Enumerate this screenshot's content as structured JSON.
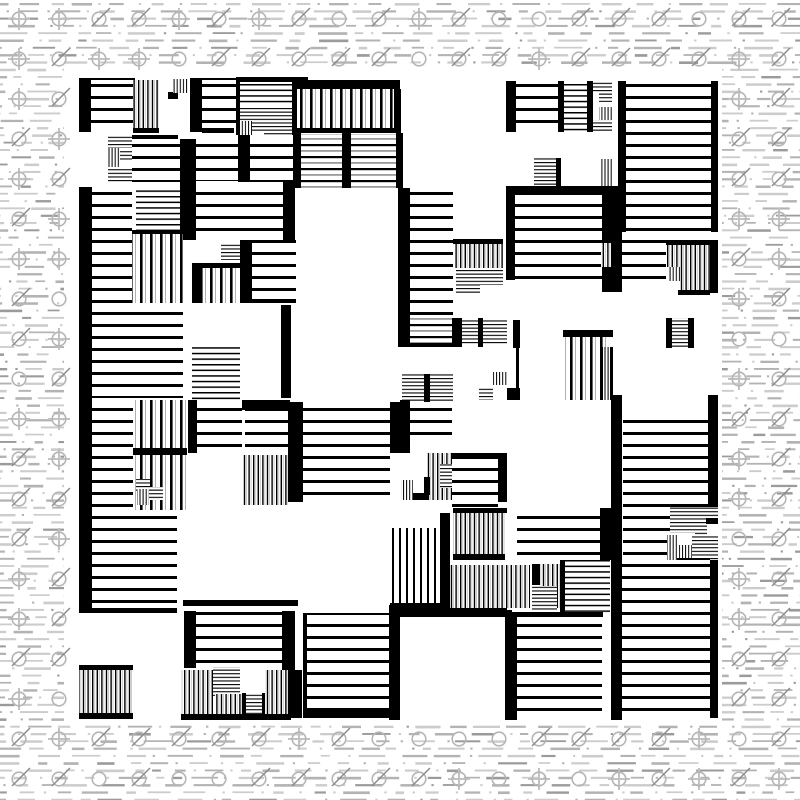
{
  "image": {
    "width": 800,
    "height": 800,
    "kind": "generative-abstract-print",
    "description": "Black-and-white generative artwork: a dense maze-like composition of solid black bars and hatched rectangles (horizontal and vertical stripes of several pitches) on a white square canvas, placed over a light technical background of gray dashed lines and circle-slash symbols"
  },
  "palette": {
    "ink": "#000000",
    "paper": "#ffffff",
    "dash_light": "#cccccc",
    "dash_mid": "#b3b3b3",
    "dash_dark": "#9b9b9b",
    "symbol_circle": "#b5b5b5",
    "symbol_slash": "#8a8a8a",
    "symbol_cross": "#c2c2c2"
  },
  "canvas": {
    "x": 64,
    "y": 64,
    "width": 658,
    "height": 658,
    "background": "#ffffff"
  },
  "margin_pattern": {
    "row_pitch": 7.3,
    "row_start": 3,
    "dash_min_len": 8,
    "dash_max_len": 30,
    "gap_min": 5,
    "gap_max": 19,
    "dot_size": 2.3,
    "dot_probability": 0.38,
    "symbol_grid_origin": 19,
    "symbol_grid_pitch": 40,
    "symbol_radius": 6.8,
    "symbol_types": [
      "slash-circle",
      "crosshair-circle",
      "plain-circle"
    ],
    "seed": 1337
  },
  "stripe_patterns": [
    {
      "id": "h-lg",
      "orientation": "horizontal",
      "pitch": 12,
      "line_thickness": 3,
      "line_color": "#000000"
    },
    {
      "id": "h-md",
      "orientation": "horizontal",
      "pitch": 12,
      "line_thickness": 2.2,
      "line_color": "#000000",
      "accent": {
        "offset": 6,
        "thickness": 1.8,
        "color": "#9a9a9a"
      }
    },
    {
      "id": "h-sm",
      "orientation": "horizontal",
      "pitch": 5.6,
      "line_thickness": 1.5,
      "line_color": "#000000"
    },
    {
      "id": "h-xs",
      "orientation": "horizontal",
      "pitch": 3.6,
      "line_thickness": 1.1,
      "line_color": "#000000"
    },
    {
      "id": "v-lg",
      "orientation": "vertical",
      "pitch": 10,
      "line_thickness": 2.6,
      "line_color": "#000000",
      "accent": {
        "offset": 5,
        "thickness": 1,
        "color": "#b0b0b0"
      }
    },
    {
      "id": "v-md",
      "orientation": "vertical",
      "pitch": 7,
      "line_thickness": 2,
      "line_color": "#000000"
    },
    {
      "id": "v-sm",
      "orientation": "vertical",
      "pitch": 4.6,
      "line_thickness": 1.4,
      "line_color": "#000000",
      "accent": {
        "offset": 2.3,
        "thickness": 0.7,
        "color": "#b8b8b8"
      }
    },
    {
      "id": "v-xs",
      "orientation": "vertical",
      "pitch": 3.1,
      "line_thickness": 1,
      "line_color": "#000000"
    }
  ],
  "blocks": {
    "legend": [
      "x",
      "y",
      "width",
      "height",
      "fill"
    ],
    "rects": [
      [
        79,
        78,
        56,
        4,
        "solid"
      ],
      [
        79,
        80,
        12,
        52,
        "solid"
      ],
      [
        91,
        80,
        42,
        52,
        "h-lg"
      ],
      [
        133,
        80,
        26,
        48,
        "v-sm"
      ],
      [
        133,
        128,
        26,
        5,
        "solid"
      ],
      [
        168,
        92,
        10,
        7,
        "solid"
      ],
      [
        173,
        79,
        15,
        14,
        "v-xs"
      ],
      [
        190,
        78,
        52,
        4,
        "solid"
      ],
      [
        190,
        80,
        12,
        52,
        "solid"
      ],
      [
        202,
        80,
        40,
        48,
        "h-lg"
      ],
      [
        202,
        128,
        32,
        5,
        "solid"
      ],
      [
        236,
        77,
        4,
        60,
        "solid"
      ],
      [
        239,
        77,
        69,
        5,
        "solid"
      ],
      [
        240,
        82,
        53,
        22,
        "h-sm"
      ],
      [
        240,
        106,
        24,
        15,
        "h-xs"
      ],
      [
        264,
        106,
        29,
        31,
        "h-xs"
      ],
      [
        240,
        121,
        12,
        16,
        "v-xs"
      ],
      [
        252,
        121,
        12,
        10,
        "h-xs"
      ],
      [
        292,
        82,
        5,
        55,
        "solid"
      ],
      [
        293,
        80,
        107,
        9,
        "solid"
      ],
      [
        297,
        89,
        97,
        39,
        "v-lg"
      ],
      [
        394,
        89,
        7,
        43,
        "solid"
      ],
      [
        293,
        128,
        108,
        5,
        "solid"
      ],
      [
        108,
        135,
        24,
        13,
        "h-xs"
      ],
      [
        107,
        148,
        13,
        19,
        "v-xs"
      ],
      [
        120,
        149,
        13,
        11,
        "h-xs"
      ],
      [
        108,
        167,
        24,
        16,
        "h-xs"
      ],
      [
        132,
        135,
        46,
        4,
        "solid"
      ],
      [
        132,
        139,
        48,
        43,
        "h-lg"
      ],
      [
        180,
        139,
        16,
        101,
        "solid"
      ],
      [
        196,
        135,
        42,
        46,
        "h-lg"
      ],
      [
        238,
        135,
        12,
        47,
        "solid"
      ],
      [
        250,
        135,
        43,
        47,
        "h-lg"
      ],
      [
        293,
        133,
        8,
        55,
        "solid"
      ],
      [
        301,
        134,
        41,
        54,
        "h-md"
      ],
      [
        342,
        133,
        9,
        55,
        "solid"
      ],
      [
        351,
        134,
        45,
        54,
        "h-md"
      ],
      [
        396,
        133,
        7,
        55,
        "solid"
      ],
      [
        79,
        187,
        13,
        213,
        "solid"
      ],
      [
        92,
        187,
        40,
        116,
        "h-lg"
      ],
      [
        136,
        189,
        44,
        41,
        "h-sm"
      ],
      [
        196,
        183,
        87,
        57,
        "h-lg"
      ],
      [
        283,
        181,
        12,
        59,
        "solid"
      ],
      [
        132,
        230,
        51,
        4,
        "solid"
      ],
      [
        132,
        234,
        51,
        69,
        "v-lg"
      ],
      [
        221,
        243,
        21,
        17,
        "h-xs"
      ],
      [
        192,
        263,
        51,
        5,
        "solid"
      ],
      [
        192,
        268,
        10,
        35,
        "solid"
      ],
      [
        202,
        268,
        41,
        35,
        "v-lg"
      ],
      [
        240,
        240,
        12,
        63,
        "solid"
      ],
      [
        252,
        240,
        44,
        63,
        "h-lg"
      ],
      [
        242,
        299,
        54,
        4,
        "solid"
      ],
      [
        92,
        303,
        91,
        95,
        "h-lg"
      ],
      [
        192,
        345,
        48,
        55,
        "h-sm"
      ],
      [
        281,
        305,
        10,
        93,
        "solid"
      ],
      [
        506,
        81,
        10,
        51,
        "solid"
      ],
      [
        516,
        81,
        42,
        51,
        "h-lg"
      ],
      [
        558,
        81,
        6,
        51,
        "solid"
      ],
      [
        564,
        81,
        23,
        51,
        "h-sm"
      ],
      [
        587,
        81,
        6,
        51,
        "solid"
      ],
      [
        593,
        81,
        19,
        11,
        "h-xs"
      ],
      [
        599,
        92,
        13,
        10,
        "h-xs"
      ],
      [
        599,
        107,
        13,
        13,
        "v-xs"
      ],
      [
        593,
        120,
        19,
        12,
        "h-xs"
      ],
      [
        618,
        81,
        8,
        151,
        "solid"
      ],
      [
        626,
        81,
        85,
        151,
        "h-lg"
      ],
      [
        711,
        81,
        7,
        151,
        "solid"
      ],
      [
        534,
        158,
        24,
        29,
        "h-xs"
      ],
      [
        556,
        158,
        5,
        29,
        "solid"
      ],
      [
        601,
        159,
        11,
        27,
        "v-xs"
      ],
      [
        506,
        186,
        97,
        7,
        "solid"
      ],
      [
        506,
        193,
        9,
        87,
        "solid"
      ],
      [
        515,
        193,
        87,
        87,
        "h-lg"
      ],
      [
        602,
        186,
        20,
        106,
        "solid"
      ],
      [
        622,
        232,
        44,
        51,
        "h-lg"
      ],
      [
        601,
        243,
        10,
        24,
        "v-sm"
      ],
      [
        666,
        240,
        50,
        5,
        "solid"
      ],
      [
        666,
        245,
        44,
        22,
        "v-sm"
      ],
      [
        668,
        267,
        12,
        14,
        "v-xs"
      ],
      [
        680,
        266,
        30,
        25,
        "v-sm"
      ],
      [
        678,
        290,
        32,
        5,
        "solid"
      ],
      [
        710,
        240,
        8,
        53,
        "solid"
      ],
      [
        398,
        188,
        12,
        159,
        "solid"
      ],
      [
        410,
        188,
        43,
        130,
        "h-lg"
      ],
      [
        410,
        318,
        42,
        25,
        "h-md"
      ],
      [
        410,
        343,
        42,
        4,
        "solid"
      ],
      [
        452,
        318,
        10,
        29,
        "solid"
      ],
      [
        462,
        320,
        16,
        25,
        "h-xs"
      ],
      [
        478,
        318,
        5,
        29,
        "solid"
      ],
      [
        483,
        320,
        24,
        25,
        "h-xs"
      ],
      [
        513,
        320,
        7,
        28,
        "solid"
      ],
      [
        516,
        348,
        3,
        52,
        "solid"
      ],
      [
        507,
        388,
        13,
        12,
        "solid"
      ],
      [
        453,
        239,
        50,
        5,
        "solid"
      ],
      [
        455,
        244,
        48,
        24,
        "v-sm"
      ],
      [
        456,
        268,
        24,
        25,
        "h-xs"
      ],
      [
        480,
        268,
        23,
        17,
        "h-xs"
      ],
      [
        666,
        318,
        6,
        30,
        "solid"
      ],
      [
        672,
        318,
        16,
        30,
        "h-xs"
      ],
      [
        688,
        318,
        6,
        30,
        "solid"
      ],
      [
        563,
        330,
        50,
        7,
        "solid"
      ],
      [
        565,
        337,
        45,
        63,
        "v-lg"
      ],
      [
        600,
        347,
        3,
        53,
        "solid"
      ],
      [
        603,
        347,
        7,
        53,
        "v-xs"
      ],
      [
        610,
        347,
        3,
        53,
        "solid"
      ],
      [
        402,
        374,
        22,
        28,
        "h-xs"
      ],
      [
        424,
        374,
        6,
        28,
        "solid"
      ],
      [
        430,
        374,
        23,
        28,
        "h-xs"
      ],
      [
        493,
        372,
        14,
        13,
        "v-xs"
      ],
      [
        479,
        387,
        14,
        13,
        "h-xs"
      ],
      [
        79,
        400,
        13,
        213,
        "solid"
      ],
      [
        92,
        400,
        41,
        110,
        "h-lg"
      ],
      [
        133,
        400,
        54,
        48,
        "v-lg"
      ],
      [
        133,
        448,
        54,
        7,
        "solid"
      ],
      [
        133,
        455,
        54,
        55,
        "v-lg"
      ],
      [
        136,
        479,
        14,
        12,
        "h-xs"
      ],
      [
        137,
        489,
        12,
        16,
        "v-xs"
      ],
      [
        149,
        487,
        14,
        13,
        "h-xs"
      ],
      [
        92,
        510,
        85,
        100,
        "h-lg"
      ],
      [
        79,
        608,
        98,
        5,
        "solid"
      ],
      [
        188,
        400,
        9,
        53,
        "solid"
      ],
      [
        197,
        400,
        45,
        53,
        "h-lg"
      ],
      [
        242,
        400,
        48,
        10,
        "solid"
      ],
      [
        245,
        410,
        43,
        43,
        "h-lg"
      ],
      [
        243,
        455,
        45,
        50,
        "v-sm"
      ],
      [
        288,
        402,
        15,
        100,
        "solid"
      ],
      [
        303,
        402,
        87,
        98,
        "h-lg"
      ],
      [
        390,
        402,
        20,
        51,
        "solid"
      ],
      [
        400,
        400,
        10,
        43,
        "solid"
      ],
      [
        410,
        402,
        42,
        41,
        "h-lg"
      ],
      [
        427,
        453,
        26,
        47,
        "v-sm"
      ],
      [
        440,
        464,
        13,
        24,
        "h-xs"
      ],
      [
        401,
        480,
        12,
        20,
        "v-xs"
      ],
      [
        413,
        493,
        16,
        7,
        "solid"
      ],
      [
        424,
        477,
        6,
        18,
        "solid"
      ],
      [
        452,
        453,
        55,
        5,
        "solid"
      ],
      [
        452,
        458,
        46,
        50,
        "h-lg"
      ],
      [
        498,
        453,
        9,
        49,
        "solid"
      ],
      [
        440,
        513,
        10,
        97,
        "solid"
      ],
      [
        453,
        508,
        54,
        5,
        "solid"
      ],
      [
        453,
        513,
        52,
        41,
        "v-sm"
      ],
      [
        453,
        554,
        52,
        6,
        "solid"
      ],
      [
        392,
        528,
        48,
        77,
        "v-md"
      ],
      [
        390,
        603,
        62,
        10,
        "solid"
      ],
      [
        450,
        565,
        80,
        43,
        "v-sm"
      ],
      [
        450,
        610,
        62,
        5,
        "solid"
      ],
      [
        532,
        564,
        8,
        21,
        "solid"
      ],
      [
        540,
        564,
        20,
        44,
        "v-sm"
      ],
      [
        532,
        585,
        9,
        25,
        "h-xs"
      ],
      [
        537,
        586,
        20,
        27,
        "h-xs"
      ],
      [
        560,
        560,
        5,
        55,
        "solid"
      ],
      [
        565,
        560,
        45,
        53,
        "h-sm"
      ],
      [
        517,
        508,
        83,
        50,
        "h-lg"
      ],
      [
        600,
        508,
        13,
        52,
        "solid"
      ],
      [
        389,
        605,
        11,
        115,
        "solid"
      ],
      [
        400,
        608,
        107,
        9,
        "solid"
      ],
      [
        505,
        612,
        12,
        108,
        "solid"
      ],
      [
        517,
        612,
        86,
        5,
        "solid"
      ],
      [
        517,
        617,
        85,
        101,
        "h-lg"
      ],
      [
        611,
        395,
        11,
        325,
        "solid"
      ],
      [
        623,
        412,
        85,
        95,
        "h-lg"
      ],
      [
        708,
        395,
        10,
        112,
        "solid"
      ],
      [
        623,
        507,
        47,
        53,
        "h-lg"
      ],
      [
        670,
        507,
        25,
        26,
        "h-xs"
      ],
      [
        695,
        507,
        23,
        13,
        "h-xs"
      ],
      [
        695,
        520,
        12,
        15,
        "h-xs"
      ],
      [
        706,
        518,
        12,
        6,
        "solid"
      ],
      [
        667,
        535,
        10,
        25,
        "v-xs"
      ],
      [
        679,
        545,
        13,
        15,
        "v-xs"
      ],
      [
        692,
        535,
        26,
        25,
        "h-xs"
      ],
      [
        677,
        558,
        33,
        5,
        "solid"
      ],
      [
        622,
        560,
        88,
        158,
        "h-lg"
      ],
      [
        710,
        560,
        8,
        158,
        "solid"
      ],
      [
        79,
        665,
        54,
        5,
        "solid"
      ],
      [
        79,
        670,
        54,
        43,
        "v-sm"
      ],
      [
        79,
        713,
        54,
        6,
        "solid"
      ],
      [
        183,
        600,
        115,
        6,
        "solid"
      ],
      [
        184,
        611,
        12,
        57,
        "solid"
      ],
      [
        196,
        612,
        86,
        55,
        "h-lg"
      ],
      [
        282,
        611,
        13,
        59,
        "solid"
      ],
      [
        181,
        670,
        32,
        46,
        "v-sm"
      ],
      [
        213,
        667,
        27,
        29,
        "h-xs"
      ],
      [
        215,
        694,
        27,
        24,
        "v-sm"
      ],
      [
        242,
        693,
        4,
        25,
        "solid"
      ],
      [
        246,
        693,
        16,
        25,
        "h-xs"
      ],
      [
        262,
        693,
        4,
        25,
        "solid"
      ],
      [
        265,
        670,
        25,
        46,
        "v-sm"
      ],
      [
        288,
        670,
        14,
        48,
        "solid"
      ],
      [
        181,
        714,
        110,
        6,
        "solid"
      ],
      [
        303,
        613,
        4,
        98,
        "solid"
      ],
      [
        307,
        613,
        82,
        97,
        "h-lg"
      ],
      [
        303,
        710,
        86,
        8,
        "solid"
      ]
    ]
  }
}
